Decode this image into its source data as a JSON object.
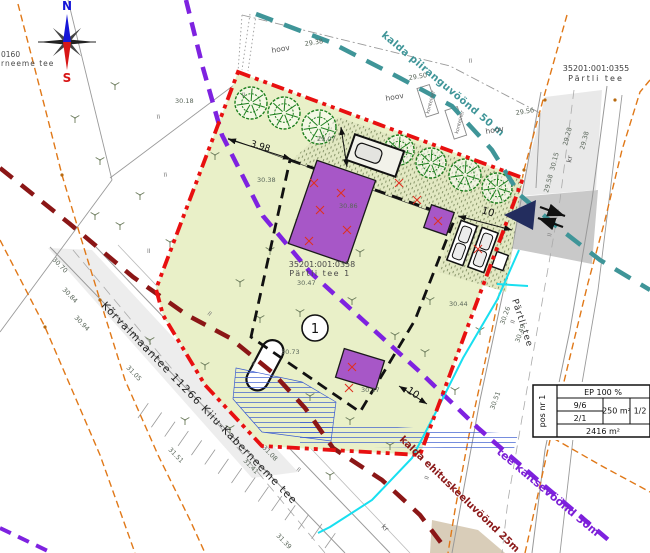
{
  "site": {
    "marker": "1",
    "cadastral_id": "35201:001:0358",
    "address": "Pärtli tee 1",
    "plot_area": "2416 m²"
  },
  "compass": {
    "north": "N",
    "south": "S"
  },
  "table": {
    "pos": "pos nr 1",
    "ep": "EP 100 %",
    "ratio_top": "9/6",
    "ratio_bottom": "2/1",
    "building_area": "250 m²",
    "storeys": "1/2",
    "plot_area": "2416 m²"
  },
  "map_labels": [
    {
      "t": "kalda piiranguvöönd 50 m",
      "x": 381,
      "y": 36,
      "rot": 40,
      "size": 10,
      "color": "#3f9598",
      "bold": 1,
      "ls": 0.4,
      "name": "label-kalda-piiranguvoond-50m"
    },
    {
      "t": "tee kaitsevöönd 30m",
      "x": 496,
      "y": 453,
      "rot": 40,
      "size": 11,
      "color": "#7c1fd6",
      "bold": 1,
      "name": "label-tee-kaitsevoond-30m"
    },
    {
      "t": "kalda ehituskeeluvöönd 25m",
      "x": 399,
      "y": 440,
      "rot": 44,
      "size": 10,
      "color": "#8b1919",
      "bold": 1,
      "name": "label-kalda-ehituskeeluvoond-25m"
    },
    {
      "t": "Kõrvalmaantee 11266 Kiiu-Kaberneeme tee",
      "x": 101,
      "y": 306,
      "rot": 46,
      "size": 10.5,
      "color": "#222",
      "ls": 1.2,
      "name": "label-road-korvalmaantee"
    },
    {
      "t": "Pärtli tee",
      "x": 512,
      "y": 300,
      "rot": 72,
      "size": 9,
      "color": "#333",
      "ls": 1,
      "name": "label-road-partli-tee"
    },
    {
      "t": "35201:001:0355",
      "x": 596,
      "y": 71,
      "size": 8,
      "color": "#3c3c3c",
      "anchor": "middle",
      "name": "label-cadastral-0355"
    },
    {
      "t": "Pärtli tee",
      "x": 596,
      "y": 81,
      "size": 8,
      "color": "#3c3c3c",
      "anchor": "middle",
      "ls": 2,
      "name": "label-cadastral-0355-name"
    },
    {
      "t": "35201:001:0358",
      "x": 322,
      "y": 267,
      "size": 8,
      "color": "#4a4a4a",
      "anchor": "middle",
      "name": "label-cadastral-0358"
    },
    {
      "t": "Pärtli tee 1",
      "x": 320,
      "y": 276,
      "size": 8,
      "color": "#4a4a4a",
      "anchor": "middle",
      "ls": 1.5,
      "name": "label-cadastral-0358-name"
    },
    {
      "t": "0160",
      "x": 1,
      "y": 57,
      "size": 7.5,
      "color": "#4a4a4a",
      "name": "label-cadastral-fragment"
    },
    {
      "t": "rneeme tee",
      "x": 1,
      "y": 66,
      "size": 7.5,
      "color": "#4a4a4a",
      "ls": 1,
      "name": "label-road-fragment"
    },
    {
      "t": "hoov",
      "x": 272,
      "y": 53,
      "rot": -10,
      "size": 7.5,
      "color": "#555",
      "name": "label-hoov"
    },
    {
      "t": "hoov",
      "x": 386,
      "y": 101,
      "rot": -10,
      "size": 7.5,
      "color": "#555",
      "name": "label-hoov"
    },
    {
      "t": "hoov",
      "x": 486,
      "y": 134,
      "rot": -10,
      "size": 7.5,
      "color": "#555",
      "name": "label-hoov"
    },
    {
      "t": "kr",
      "x": 571,
      "y": 163,
      "rot": -78,
      "size": 7,
      "color": "#555",
      "name": "label-kr"
    },
    {
      "t": "kr",
      "x": 381,
      "y": 527,
      "rot": 45,
      "size": 7,
      "color": "#555",
      "name": "label-kr"
    },
    {
      "t": "konteiner",
      "x": 429,
      "y": 114,
      "rot": -75,
      "size": 5,
      "color": "#666",
      "name": "label-konteiner"
    },
    {
      "t": "konteiner",
      "x": 458,
      "y": 134,
      "rot": -75,
      "size": 5,
      "color": "#666",
      "name": "label-konteiner"
    },
    {
      "t": "3.98",
      "x": 250,
      "y": 146,
      "rot": 17,
      "size": 9,
      "color": "#111",
      "name": "dimension-label"
    },
    {
      "t": "10",
      "x": 481,
      "y": 213,
      "rot": 17,
      "size": 10,
      "color": "#111",
      "name": "dimension-label"
    },
    {
      "t": "10",
      "x": 406,
      "y": 392,
      "rot": 33,
      "size": 10,
      "color": "#111",
      "name": "dimension-label"
    }
  ],
  "elevations": [
    {
      "t": "30.18",
      "x": 175,
      "y": 103
    },
    {
      "t": "29.38",
      "x": 305,
      "y": 46,
      "rot": -9
    },
    {
      "t": "29.50",
      "x": 409,
      "y": 80,
      "rot": -9
    },
    {
      "t": "29.56",
      "x": 516,
      "y": 115,
      "rot": -9
    },
    {
      "t": "29.07",
      "x": 317,
      "y": 141
    },
    {
      "t": "30.38",
      "x": 257,
      "y": 182
    },
    {
      "t": "30.86",
      "x": 339,
      "y": 208
    },
    {
      "t": "30.44",
      "x": 449,
      "y": 306
    },
    {
      "t": "30.73",
      "x": 281,
      "y": 354
    },
    {
      "t": "30.17",
      "x": 361,
      "y": 392
    },
    {
      "t": "30.47",
      "x": 297,
      "y": 285
    },
    {
      "t": "29.28",
      "x": 567,
      "y": 146,
      "rot": -75
    },
    {
      "t": "29.38",
      "x": 584,
      "y": 150,
      "rot": -75
    },
    {
      "t": "30.15",
      "x": 554,
      "y": 171,
      "rot": -75
    },
    {
      "t": "29.58",
      "x": 548,
      "y": 193,
      "rot": -75
    },
    {
      "t": "30.26",
      "x": 504,
      "y": 325,
      "rot": -70
    },
    {
      "t": "30.49",
      "x": 519,
      "y": 343,
      "rot": -70
    },
    {
      "t": "30.51",
      "x": 494,
      "y": 410,
      "rot": -70
    },
    {
      "t": "31.08",
      "x": 262,
      "y": 448,
      "rot": 46
    },
    {
      "t": "31.41",
      "x": 243,
      "y": 461,
      "rot": 46
    },
    {
      "t": "31.39",
      "x": 276,
      "y": 536,
      "rot": 46
    },
    {
      "t": "30.70",
      "x": 52,
      "y": 260,
      "rot": 46
    },
    {
      "t": "30.84",
      "x": 62,
      "y": 290,
      "rot": 46
    },
    {
      "t": "30.94",
      "x": 74,
      "y": 318,
      "rot": 46
    },
    {
      "t": "31.05",
      "x": 126,
      "y": 368,
      "rot": 46
    },
    {
      "t": "31.51",
      "x": 168,
      "y": 450,
      "rot": 46
    }
  ]
}
